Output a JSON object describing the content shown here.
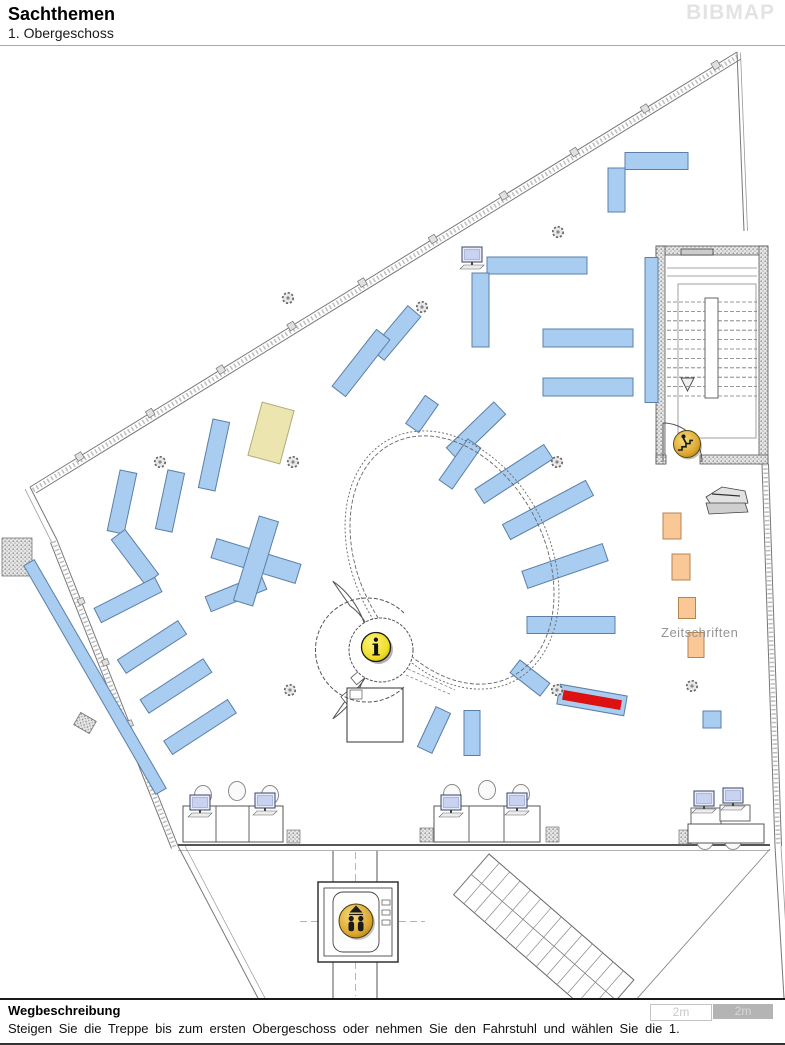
{
  "header": {
    "title": "Sachthemen",
    "subtitle": "1. Obergeschoss",
    "logo": "BIBMAP"
  },
  "footer": {
    "heading": "Wegbeschreibung",
    "description": "Steigen Sie die Treppe bis zum ersten Obergeschoss oder nehmen Sie den Fahrstuhl und wählen Sie die 1.",
    "scale": [
      {
        "label": "2m"
      },
      {
        "label": "2m"
      }
    ]
  },
  "map": {
    "magazines_label": "Zeitschriften",
    "colors": {
      "shelf": "#a9cdf1",
      "shelf_border": "#5b7fa6",
      "magazine": "#fac896",
      "magazine_border": "#b5854e",
      "highlight": "#dd1111",
      "special": "#ece5af",
      "special_border": "#b3ab76",
      "gold": "#e0a82e",
      "info_yellow": "#f2e12f"
    },
    "shelves": [
      {
        "cx": 616.5,
        "cy": 190,
        "len": 44,
        "w": 17,
        "rot": 90
      },
      {
        "cx": 656.5,
        "cy": 161,
        "len": 63,
        "w": 17,
        "rot": 0
      },
      {
        "cx": 537,
        "cy": 265.5,
        "len": 100,
        "w": 17,
        "rot": 0
      },
      {
        "cx": 480.5,
        "cy": 310,
        "len": 74,
        "w": 17,
        "rot": 90
      },
      {
        "cx": 588,
        "cy": 338,
        "len": 90,
        "w": 18,
        "rot": 0
      },
      {
        "cx": 588,
        "cy": 387,
        "len": 90,
        "w": 18,
        "rot": 0
      },
      {
        "cx": 651.5,
        "cy": 330,
        "len": 145,
        "w": 13,
        "rot": 90
      },
      {
        "cx": 396,
        "cy": 333,
        "len": 57,
        "w": 17,
        "rot": -50
      },
      {
        "cx": 361,
        "cy": 363,
        "len": 72,
        "w": 17,
        "rot": -52
      },
      {
        "cx": 422,
        "cy": 414,
        "len": 34,
        "w": 16,
        "rot": -55
      },
      {
        "cx": 476,
        "cy": 431,
        "len": 66,
        "w": 17,
        "rot": -44
      },
      {
        "cx": 460,
        "cy": 464,
        "len": 50,
        "w": 16,
        "rot": -55
      },
      {
        "cx": 514,
        "cy": 474,
        "len": 82,
        "w": 17,
        "rot": -33
      },
      {
        "cx": 548,
        "cy": 510,
        "len": 94,
        "w": 17,
        "rot": -28
      },
      {
        "cx": 565,
        "cy": 566,
        "len": 85,
        "w": 18,
        "rot": -19
      },
      {
        "cx": 571,
        "cy": 625,
        "len": 88,
        "w": 17,
        "rot": 0
      },
      {
        "cx": 530,
        "cy": 678,
        "len": 38,
        "w": 16,
        "rot": 38
      },
      {
        "cx": 434,
        "cy": 730,
        "len": 44,
        "w": 16,
        "rot": -65
      },
      {
        "cx": 472,
        "cy": 733,
        "len": 45,
        "w": 16,
        "rot": 90
      },
      {
        "cx": 122,
        "cy": 502,
        "len": 62,
        "w": 17,
        "rot": -78
      },
      {
        "cx": 170,
        "cy": 501,
        "len": 60,
        "w": 17,
        "rot": -78
      },
      {
        "cx": 214,
        "cy": 455,
        "len": 70,
        "w": 17,
        "rot": -78
      },
      {
        "cx": 135,
        "cy": 557,
        "len": 56,
        "w": 17,
        "rot": 53
      },
      {
        "cx": 236,
        "cy": 593,
        "len": 60,
        "w": 16,
        "rot": -22
      },
      {
        "cx": 128,
        "cy": 600,
        "len": 68,
        "w": 16,
        "rot": -27
      },
      {
        "cx": 152,
        "cy": 647,
        "len": 72,
        "w": 16,
        "rot": -33
      },
      {
        "cx": 176,
        "cy": 686,
        "len": 75,
        "w": 16,
        "rot": -33
      },
      {
        "cx": 200,
        "cy": 727,
        "len": 76,
        "w": 16,
        "rot": -33
      },
      {
        "cx": 95,
        "cy": 677,
        "len": 264,
        "w": 12,
        "rot": 60
      },
      {
        "cx": 712,
        "cy": 719.5,
        "len": 18,
        "w": 17,
        "rot": 0
      },
      {
        "cx": 256,
        "cy": 561,
        "len": 88,
        "w": 20,
        "rot": 17
      },
      {
        "cx": 256,
        "cy": 561,
        "len": 88,
        "w": 20,
        "rot": 107
      }
    ],
    "special_shelf": {
      "cx": 271,
      "cy": 433,
      "len": 55,
      "w": 33,
      "rot": -75
    },
    "magazine_shelves": [
      {
        "cx": 672,
        "cy": 526,
        "len": 26,
        "w": 18,
        "rot": 90
      },
      {
        "cx": 681,
        "cy": 567,
        "len": 26,
        "w": 18,
        "rot": 90
      },
      {
        "cx": 687,
        "cy": 608,
        "len": 21,
        "w": 17,
        "rot": 90
      },
      {
        "cx": 696,
        "cy": 645,
        "len": 25,
        "w": 16,
        "rot": 90
      }
    ],
    "highlight_shelf": {
      "cx": 592,
      "cy": 700,
      "len": 68,
      "w": 20,
      "rot": 10,
      "inner_len": 58,
      "inner_w": 9
    },
    "hatch_blocks": [
      [
        287,
        830,
        13,
        13
      ],
      [
        420,
        828,
        13,
        14
      ],
      [
        546,
        827,
        13,
        15
      ],
      [
        679,
        830,
        12,
        14
      ]
    ],
    "columns": [
      [
        288,
        298
      ],
      [
        422,
        307
      ],
      [
        558,
        232
      ],
      [
        160,
        462
      ],
      [
        293,
        462
      ],
      [
        557,
        462
      ],
      [
        290,
        690
      ],
      [
        557,
        690
      ],
      [
        692,
        686
      ]
    ],
    "computer_top": [
      462,
      247
    ],
    "workstations": [
      {
        "desk": [
          183,
          806,
          100,
          36
        ],
        "dividers": [
          216,
          249
        ],
        "monitors": [
          [
            190,
            795
          ],
          [
            255,
            793
          ]
        ],
        "chairs": [
          [
            203,
            795
          ],
          [
            237,
            791
          ],
          [
            270,
            795
          ]
        ],
        "tables": []
      },
      {
        "desk": [
          434,
          806,
          106,
          36
        ],
        "dividers": [
          469,
          504
        ],
        "monitors": [
          [
            441,
            795
          ],
          [
            507,
            793
          ]
        ],
        "chairs": [
          [
            452,
            794
          ],
          [
            487,
            790
          ],
          [
            521,
            794
          ]
        ],
        "tables": []
      },
      {
        "desk": [
          688,
          824,
          76,
          19
        ],
        "dividers": [],
        "monitors": [
          [
            694,
            791
          ],
          [
            723,
            788
          ]
        ],
        "chairs": [
          [
            705,
            840
          ],
          [
            733,
            840
          ]
        ],
        "tables": [
          [
            691,
            808,
            30,
            16
          ],
          [
            720,
            805,
            30,
            16
          ]
        ]
      }
    ],
    "icons": {
      "info": {
        "cx": 376,
        "cy": 647,
        "r": 14.5
      },
      "elevator": {
        "cx": 356,
        "cy": 921,
        "r": 17
      },
      "stairs_exit": {
        "cx": 687,
        "cy": 444,
        "r": 13.5
      }
    }
  }
}
